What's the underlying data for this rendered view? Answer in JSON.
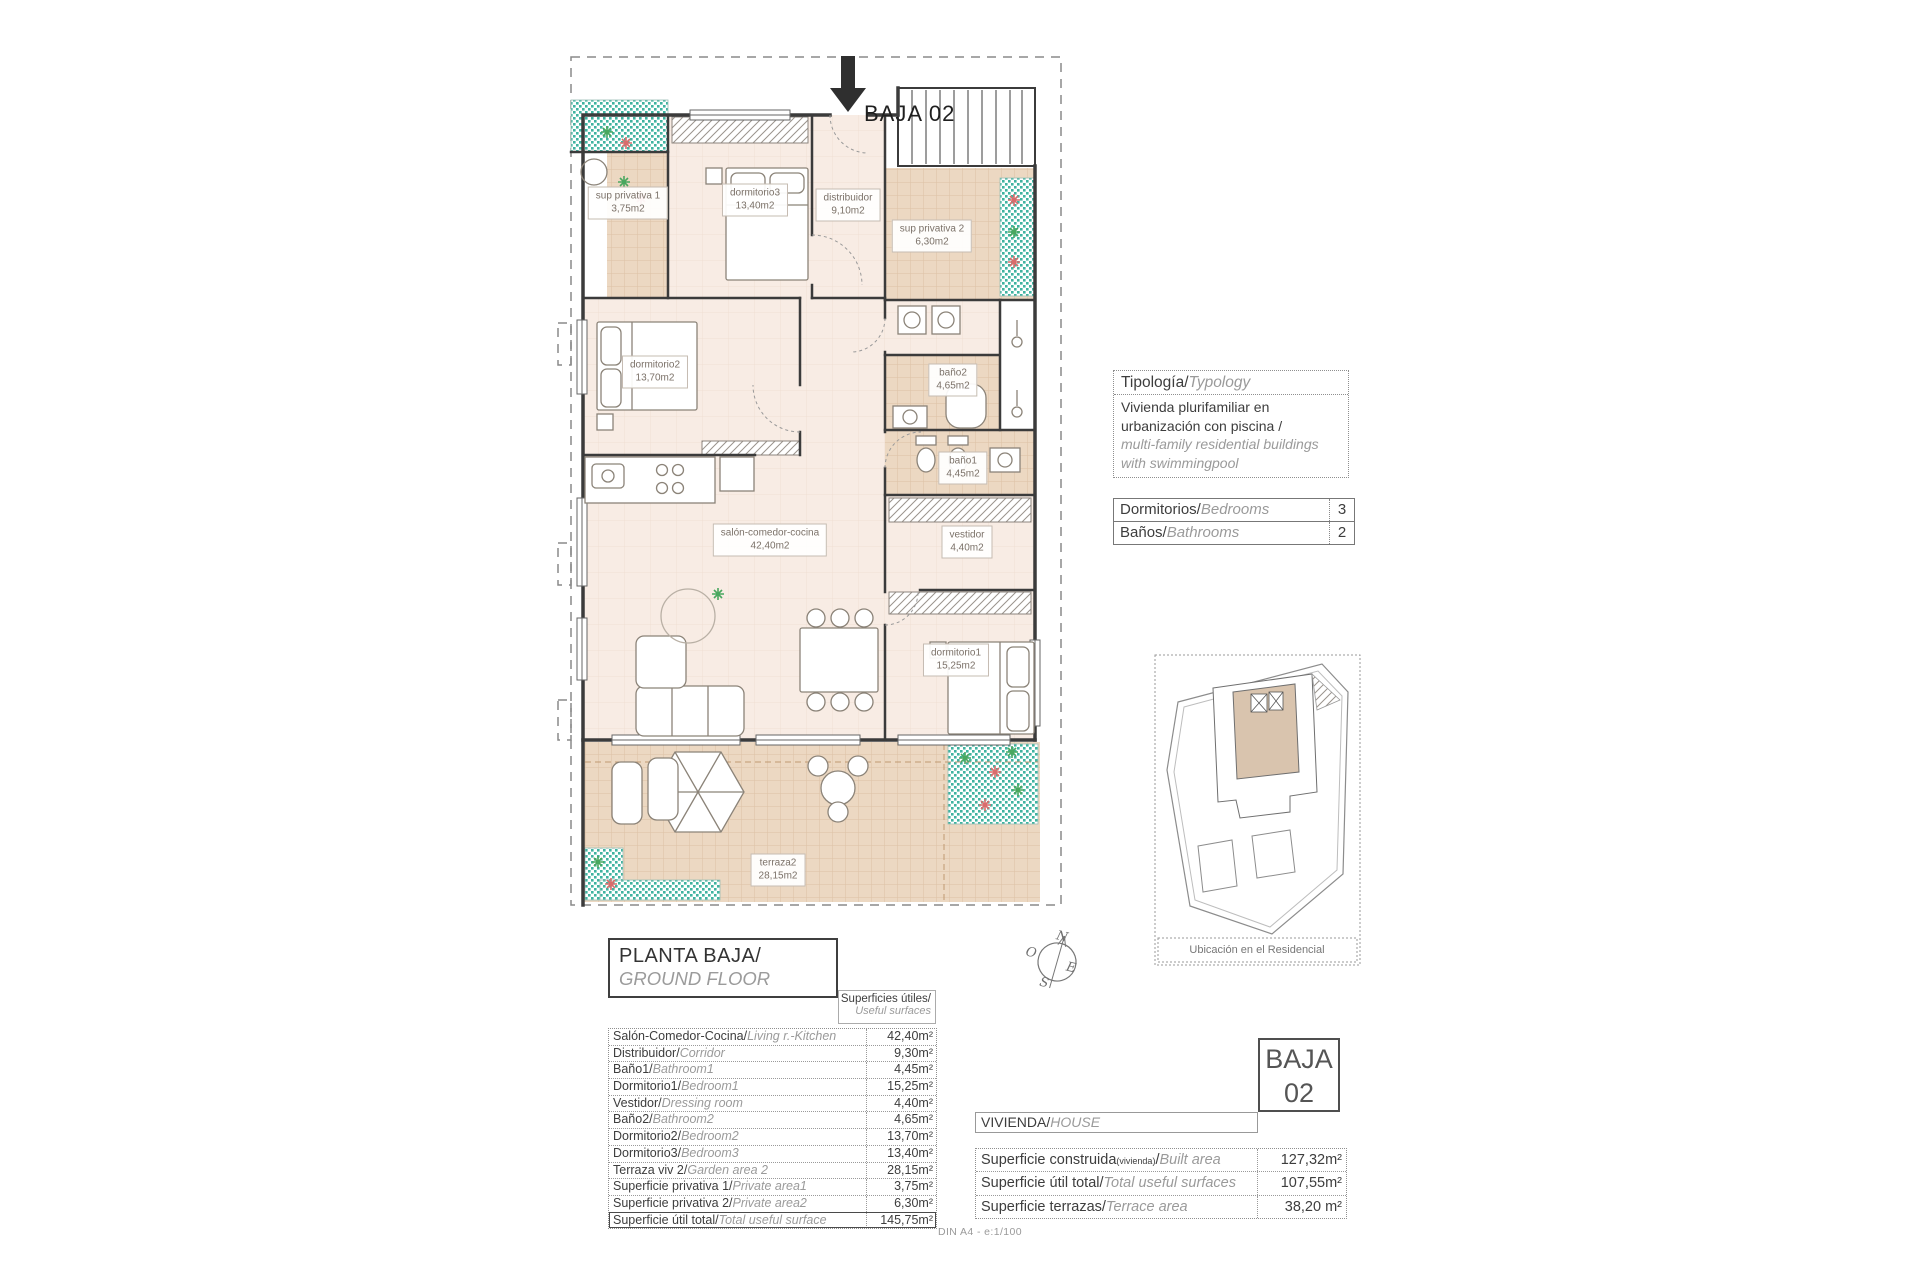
{
  "entrance": {
    "label": "BAJA 02"
  },
  "plan": {
    "rooms": [
      {
        "name": "sup privativa 1",
        "area": "3,75m2"
      },
      {
        "name": "dormitorio3",
        "area": "13,40m2"
      },
      {
        "name": "distribuidor",
        "area": "9,10m2"
      },
      {
        "name": "sup privativa 2",
        "area": "6,30m2"
      },
      {
        "name": "dormitorio2",
        "area": "13,70m2"
      },
      {
        "name": "baño2",
        "area": "4,65m2"
      },
      {
        "name": "baño1",
        "area": "4,45m2"
      },
      {
        "name": "salón-comedor-cocina",
        "area": "42,40m2"
      },
      {
        "name": "vestidor",
        "area": "4,40m2"
      },
      {
        "name": "dormitorio1",
        "area": "15,25m2"
      },
      {
        "name": "terraza2",
        "area": "28,15m2"
      }
    ]
  },
  "typology": {
    "title_es": "Tipología/",
    "title_en": "Typology",
    "body_es_1": "Vivienda plurifamiliar en",
    "body_es_2": "urbanización con piscina  /",
    "body_en_1": "multi-family residential buildings",
    "body_en_2": "with swimmingpool"
  },
  "counts": {
    "rows": [
      {
        "label_es": "Dormitorios/",
        "label_en": "Bedrooms",
        "value": "3"
      },
      {
        "label_es": "Baños/",
        "label_en": "Bathrooms",
        "value": "2"
      }
    ]
  },
  "site_plan": {
    "caption": "Ubicación en el Residencial"
  },
  "compass": {
    "north": "N",
    "south": "S",
    "east": "E",
    "west": "O"
  },
  "floor_title": {
    "es": "PLANTA BAJA/",
    "en": "GROUND FLOOR"
  },
  "useful_surfaces": {
    "header_es": "Superficies útiles/",
    "header_en": "Useful surfaces",
    "rows": [
      {
        "label_es": "Salón-Comedor-Cocina/",
        "label_en": "Living r.-Kitchen",
        "value": "42,40m²"
      },
      {
        "label_es": "Distribuidor/",
        "label_en": "Corridor",
        "value": "9,30m²"
      },
      {
        "label_es": "Baño1/",
        "label_en": "Bathroom1",
        "value": "4,45m²"
      },
      {
        "label_es": "Dormitorio1/",
        "label_en": "Bedroom1",
        "value": "15,25m²"
      },
      {
        "label_es": "Vestidor/",
        "label_en": "Dressing room",
        "value": "4,40m²"
      },
      {
        "label_es": "Baño2/",
        "label_en": "Bathroom2",
        "value": "4,65m²"
      },
      {
        "label_es": "Dormitorio2/",
        "label_en": "Bedroom2",
        "value": "13,70m²"
      },
      {
        "label_es": "Dormitorio3/",
        "label_en": "Bedroom3",
        "value": "13,40m²"
      },
      {
        "label_es": "Terraza viv 2/",
        "label_en": "Garden area 2",
        "value": "28,15m²"
      },
      {
        "label_es": "Superficie privativa 1/",
        "label_en": "Private area1",
        "value": "3,75m²"
      },
      {
        "label_es": "Superficie privativa 2/",
        "label_en": "Private area2",
        "value": "6,30m²"
      },
      {
        "label_es": "Superficie útil total/",
        "label_en": "Total useful surface",
        "value": "145,75m²"
      }
    ]
  },
  "unit_box": {
    "line1": "BAJA",
    "line2": "02"
  },
  "house_header": {
    "es": "VIVIENDA/",
    "en": "HOUSE"
  },
  "house_table": {
    "rows": [
      {
        "label_es": "Superficie construida",
        "label_note": "(vivienda)",
        "label_slash": "/",
        "label_en": "Built area",
        "value": "127,32m²"
      },
      {
        "label_es": "Superficie útil total/",
        "label_en": "Total useful surfaces",
        "value": "107,55m²"
      },
      {
        "label_es": "Superficie terrazas/",
        "label_en": "Terrace area",
        "value": "38,20 m²"
      }
    ]
  },
  "footer": {
    "scale_text": "DIN A4 - e:1/100"
  },
  "colors": {
    "wall": "#3b3b3b",
    "tile_floor": "#ecd8c2",
    "teal_garden": "#3fb3a0",
    "room_floor": "#f8ece4",
    "plant_green": "#49a75f",
    "plant_red": "#d96c6c"
  }
}
